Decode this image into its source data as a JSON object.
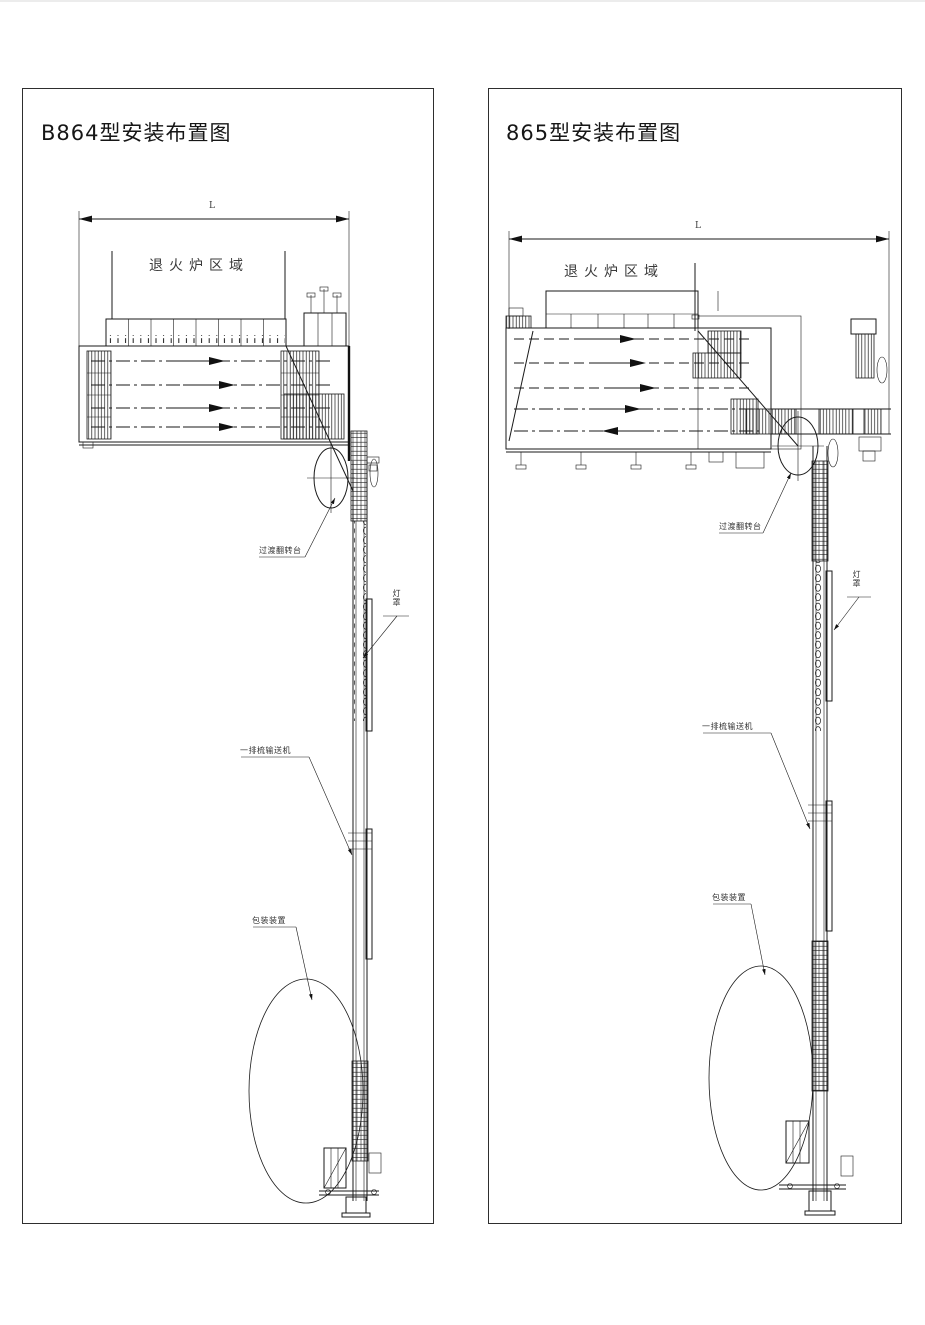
{
  "page": {
    "background": "#ffffff",
    "line_color": "#1a1a1a",
    "drawing_type": "installation-layout-engineering-drawing"
  },
  "panels": [
    {
      "title": "B864型安装布置图",
      "dimension_label": "L",
      "furnace_zone_label": "退火炉区域",
      "callouts": [
        {
          "label": "过渡翻转台"
        },
        {
          "label": "灯罩"
        },
        {
          "label": "一排梳输送机"
        },
        {
          "label": "包装装置"
        }
      ]
    },
    {
      "title": "865型安装布置图",
      "dimension_label": "L",
      "furnace_zone_label": "退火炉区域",
      "callouts": [
        {
          "label": "过渡翻转台"
        },
        {
          "label": "灯罩"
        },
        {
          "label": "一排梳输送机"
        },
        {
          "label": "包装装置"
        }
      ]
    }
  ]
}
